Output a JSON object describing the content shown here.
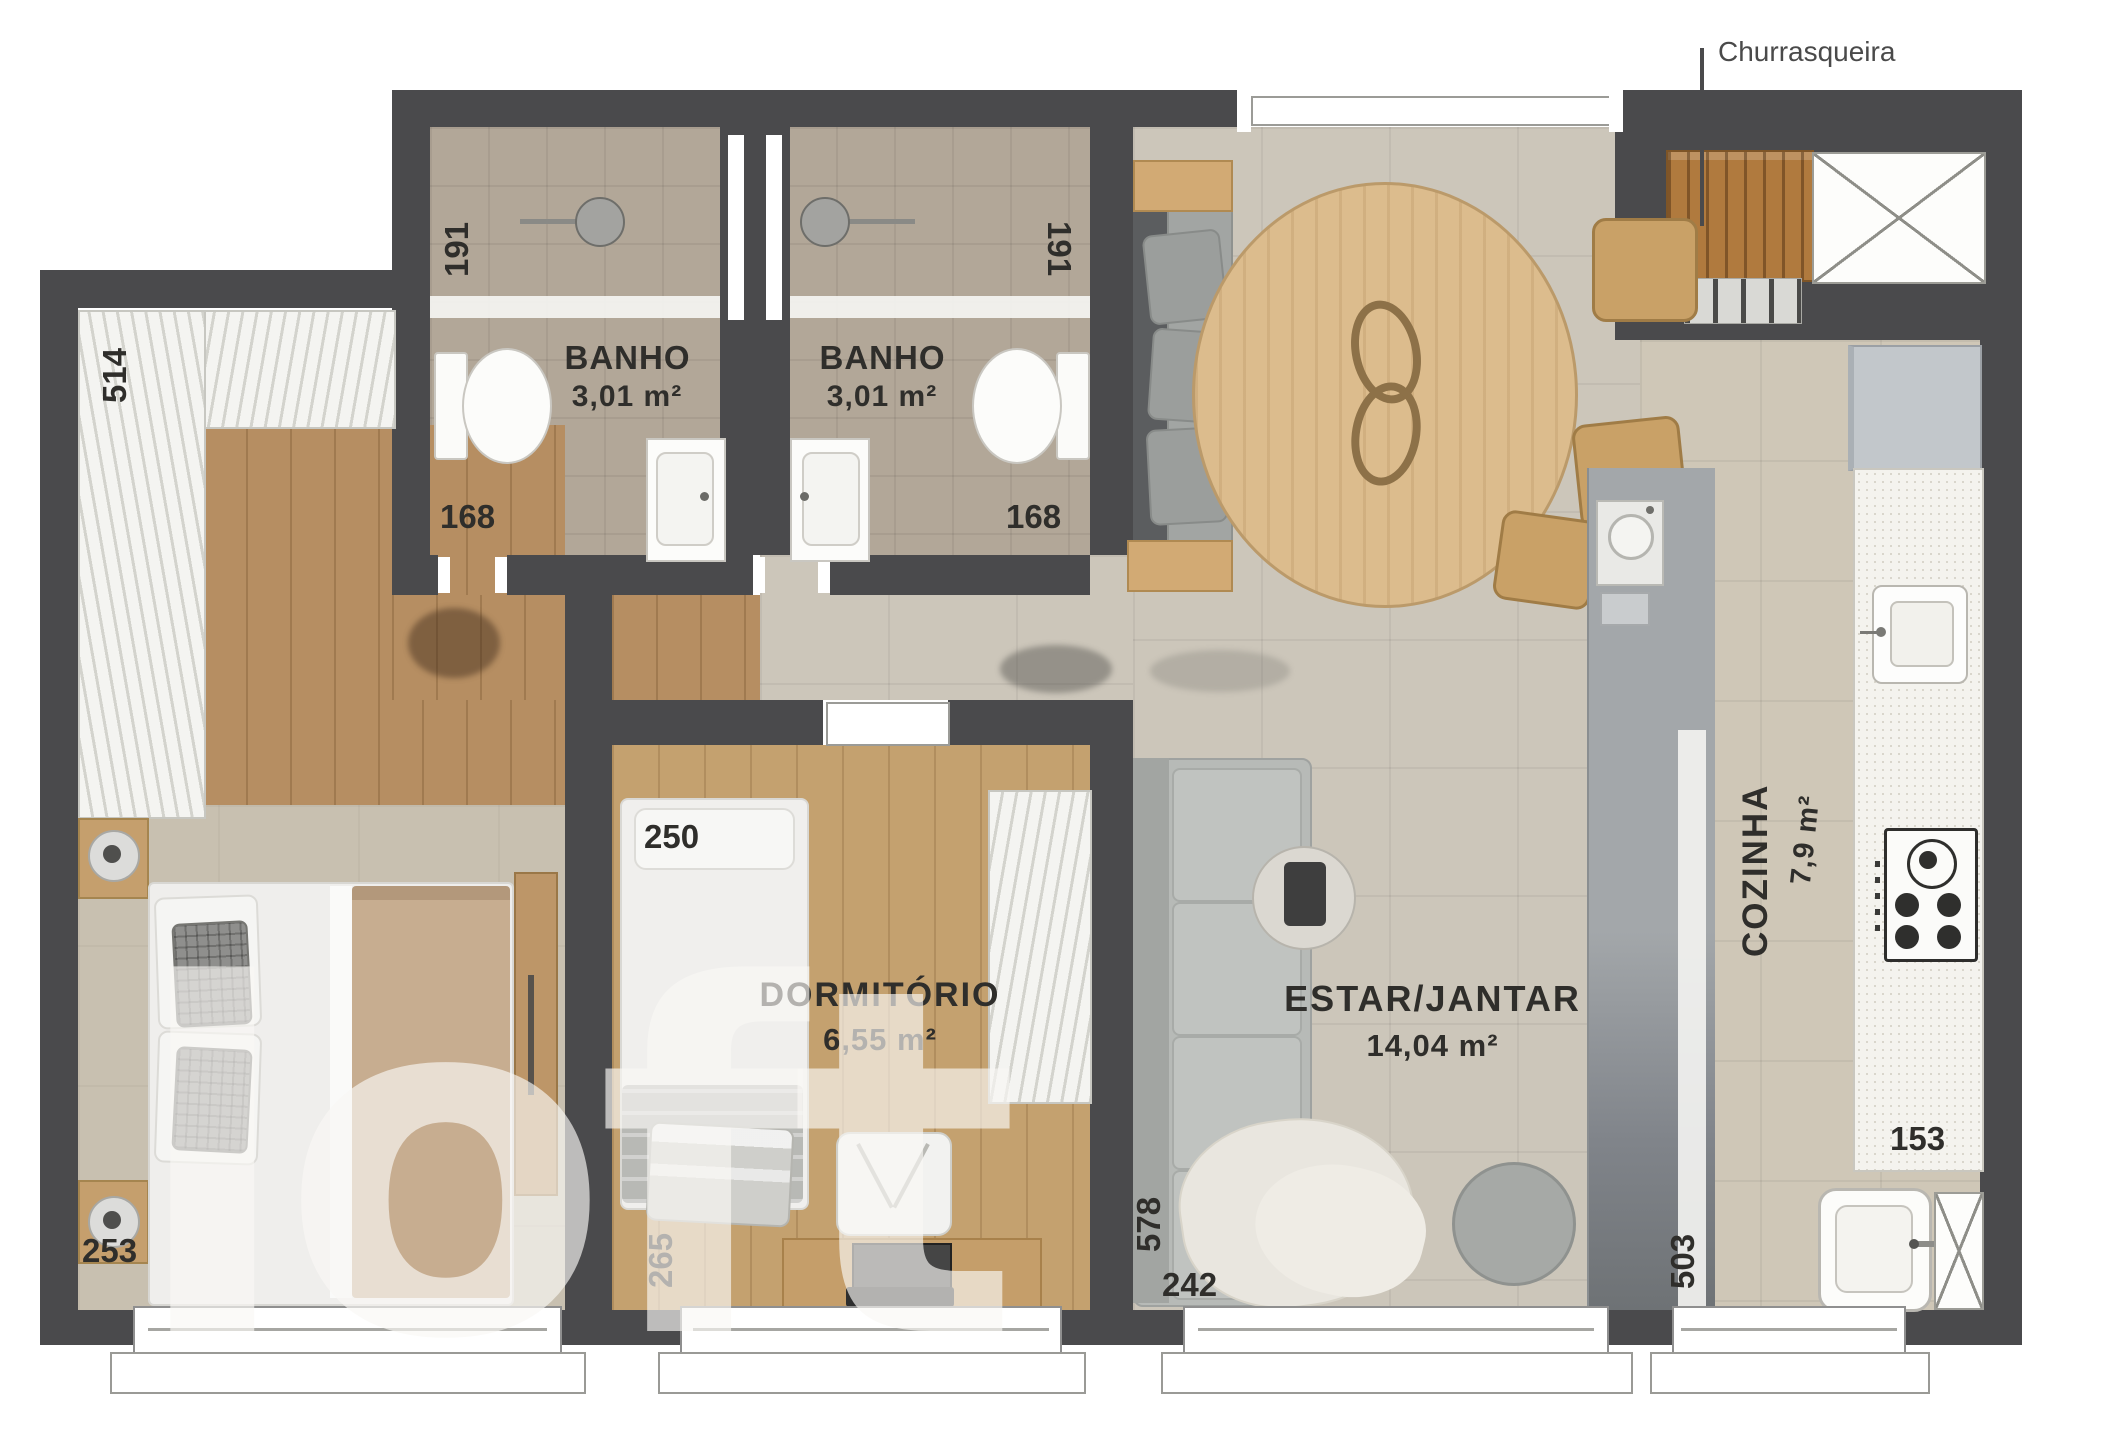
{
  "watermark": "loft",
  "labels": {
    "churrasqueira": "Churrasqueira"
  },
  "rooms": {
    "banho_left": {
      "name": "BANHO",
      "area": "3,01 m²"
    },
    "banho_right": {
      "name": "BANHO",
      "area": "3,01 m²"
    },
    "dormitorio": {
      "name": "DORMITÓRIO",
      "area": "6,55 m²"
    },
    "estar_jantar": {
      "name": "ESTAR/JANTAR",
      "area": "14,04 m²"
    },
    "cozinha": {
      "name": "COZINHA",
      "area": "7,9 m²"
    }
  },
  "dimensions_cm": {
    "closet": "514",
    "banho_left_depth": "191",
    "banho_right_depth": "191",
    "banho_left_width": "168",
    "banho_right_width": "168",
    "dormitorio_width": "250",
    "dormitorio_depth": "265",
    "master_window": "253",
    "estar_depth": "578",
    "estar_window": "242",
    "cozinha_depth": "503",
    "cozinha_width": "153"
  },
  "colors": {
    "wall": "#4a4a4c",
    "living_tile": "#ccc6ba",
    "bath_tile": "#b2a798",
    "wood_master": "#b68e62",
    "wood_dorm": "#c4a16f",
    "carpet": "#c8c0b0",
    "counter_white": "#f4f3ee",
    "peninsula_gray": "#9aa0a4",
    "table_wood": "#dcbc8d",
    "grill_wood": "#b07a3e",
    "label_text": "#2f2e2b",
    "watermark_white": "#f9f8f4"
  }
}
